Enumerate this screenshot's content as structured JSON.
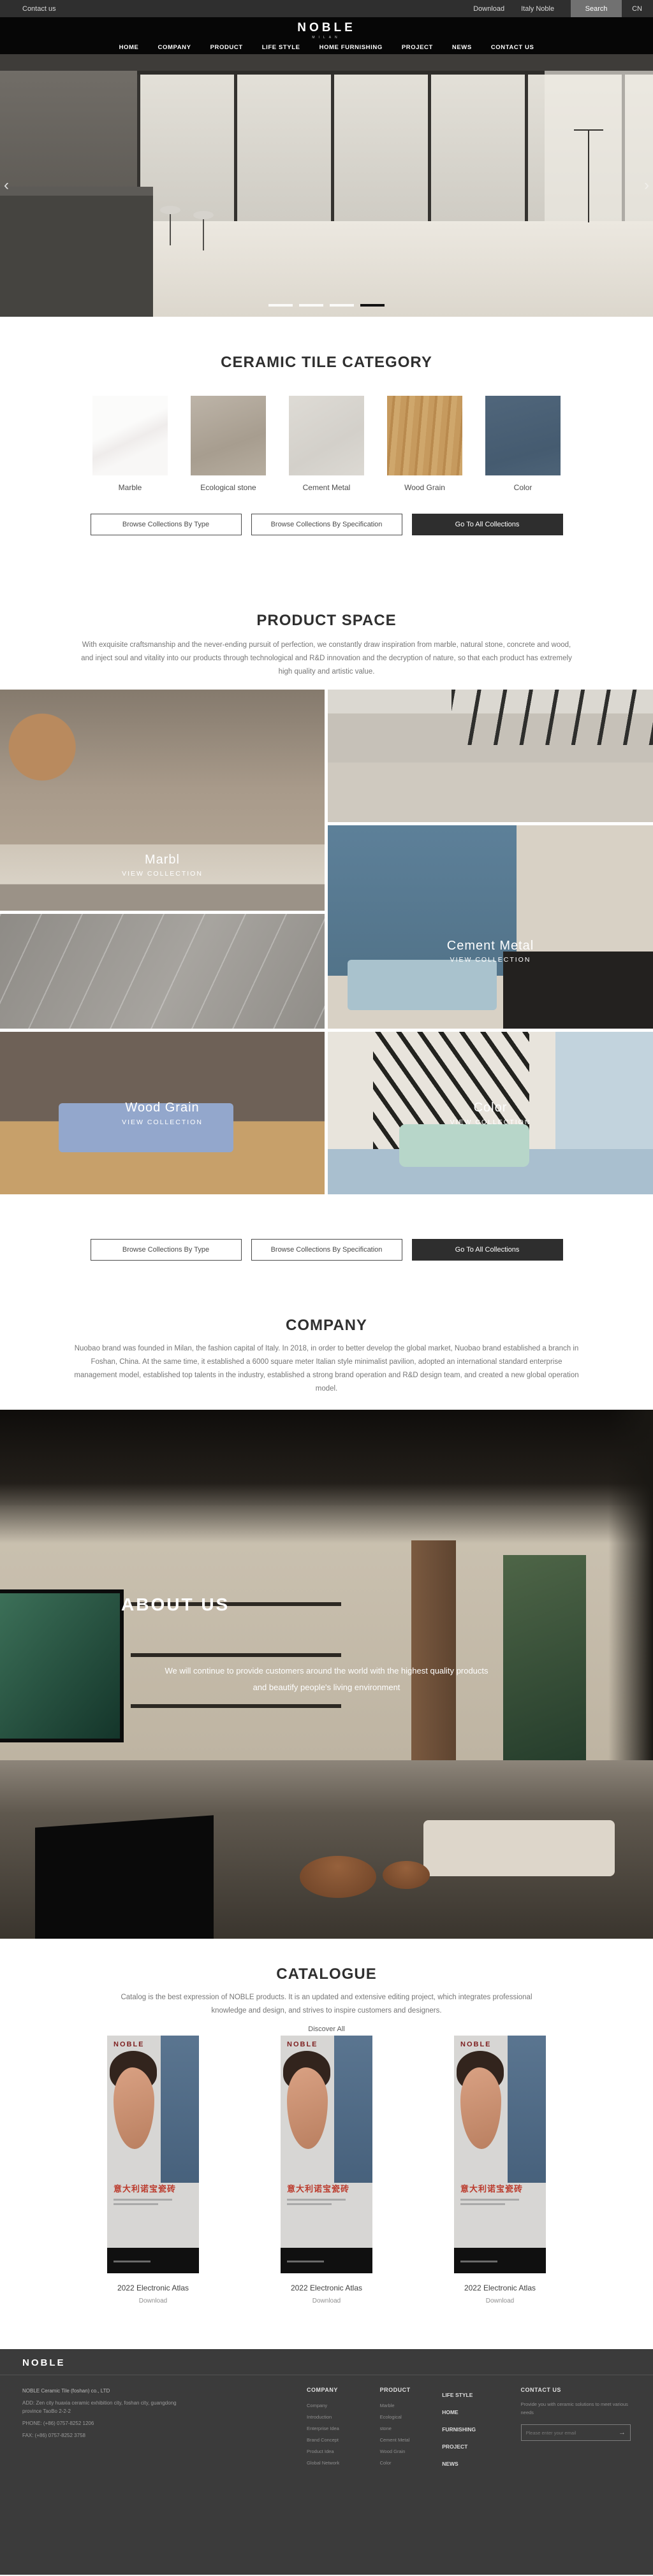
{
  "topbar": {
    "contact_us": "Contact us",
    "download": "Download",
    "italy_noble": "Italy Noble",
    "search": "Search",
    "language": "CN"
  },
  "header": {
    "logo": "NOBLE",
    "logo_subtitle": "MILAN",
    "nav": [
      "HOME",
      "COMPANY",
      "PRODUCT",
      "LIFE STYLE",
      "HOME FURNISHING",
      "PROJECT",
      "NEWS",
      "CONTACT US"
    ]
  },
  "hero": {
    "slide_count": 4,
    "active_slide": 4,
    "prev_icon": "‹",
    "next_icon": "›"
  },
  "category": {
    "title": "CERAMIC TILE CATEGORY",
    "items": [
      {
        "label": "Marble",
        "color": "#f6f5f3"
      },
      {
        "label": "Ecological stone",
        "color": "#b2a89b"
      },
      {
        "label": "Cement Metal",
        "color": "#dbd8d2"
      },
      {
        "label": "Wood Grain",
        "color": "#c69a5e"
      },
      {
        "label": "Color",
        "color": "#4d6377"
      }
    ]
  },
  "collection_buttons": {
    "by_type": "Browse Collections By Type",
    "by_specification": "Browse Collections By Specification",
    "go_to_all": "Go To All Collections",
    "accent_color": "#2e2e2e"
  },
  "product_space": {
    "title": "PRODUCT SPACE",
    "description": "With exquisite craftsmanship and the never-ending pursuit of perfection, we constantly draw inspiration from marble, natural stone, concrete and wood, and inject soul and vitality into our products through technological and R&D innovation and the decryption of nature, so that each product has extremely high quality and artistic value.",
    "gallery": [
      {
        "label": "Marbl",
        "cta": "VIEW COLLECTION"
      },
      {
        "label": "Cement Metal",
        "cta": "VIEW COLLECTION"
      },
      {
        "label": "Wood Grain",
        "cta": "VIEW COLLECTION"
      },
      {
        "label": "Color",
        "cta": "VIEW COLLECTION"
      }
    ]
  },
  "company": {
    "title": "COMPANY",
    "description": "Nuobao brand was founded in Milan, the fashion capital of Italy. In 2018, in order to better develop the global market, Nuobao brand established a branch in Foshan, China. At the same time, it established a 6000 square meter Italian style minimalist pavilion, adopted an international standard enterprise management model, established top talents in the industry, established a strong brand operation and R&D design team, and created a new global operation model."
  },
  "about": {
    "title": "ABOUT US",
    "line1": "We will continue to provide customers around the world with the highest quality products",
    "line2": "and beautify people's living environment"
  },
  "catalogue": {
    "title": "CATALOGUE",
    "description": "Catalog is the best expression of NOBLE products. It is an updated and extensive editing project, which integrates professional knowledge and design, and strives to inspire customers and designers.",
    "discover_all": "Discover All",
    "covers": [
      {
        "logo": "NOBLE",
        "title_cn": "意大利诺宝瓷砖",
        "caption": "2022 Electronic Atlas",
        "download": "Download"
      },
      {
        "logo": "NOBLE",
        "title_cn": "意大利诺宝瓷砖",
        "caption": "2022 Electronic Atlas",
        "download": "Download"
      },
      {
        "logo": "NOBLE",
        "title_cn": "意大利诺宝瓷砖",
        "caption": "2022 Electronic Atlas",
        "download": "Download"
      }
    ]
  },
  "footer": {
    "background": "#3b3b3b",
    "logo": "NOBLE",
    "company_name": "NOBLE Ceramic Tile (foshan) co., LTD",
    "address": "ADD: Zen city huaxia ceramic exhibition city, foshan city, guangdong province TaoBo 2-2-2",
    "phone": "PHONE: (+86) 0757-8252 1206",
    "fax": "FAX: (+86) 0757-8252 3758",
    "columns": {
      "company": {
        "title": "COMPANY",
        "links": [
          "Company Introduction",
          "Enterprise Idea",
          "Brand Concept",
          "Product Idea",
          "Global Network"
        ]
      },
      "product": {
        "title": "PRODUCT",
        "links": [
          "Marble",
          "Ecological stone",
          "Cement Metal",
          "Wood Grain",
          "Color"
        ]
      },
      "nav": {
        "links": [
          "LIFE STYLE",
          "HOME FURNISHING",
          "PROJECT",
          "NEWS"
        ]
      }
    },
    "contact": {
      "title": "CONTACT US",
      "text": "Provide you with ceramic solutions to meet various needs",
      "placeholder": "Please enter your email",
      "send_icon": "→"
    }
  }
}
